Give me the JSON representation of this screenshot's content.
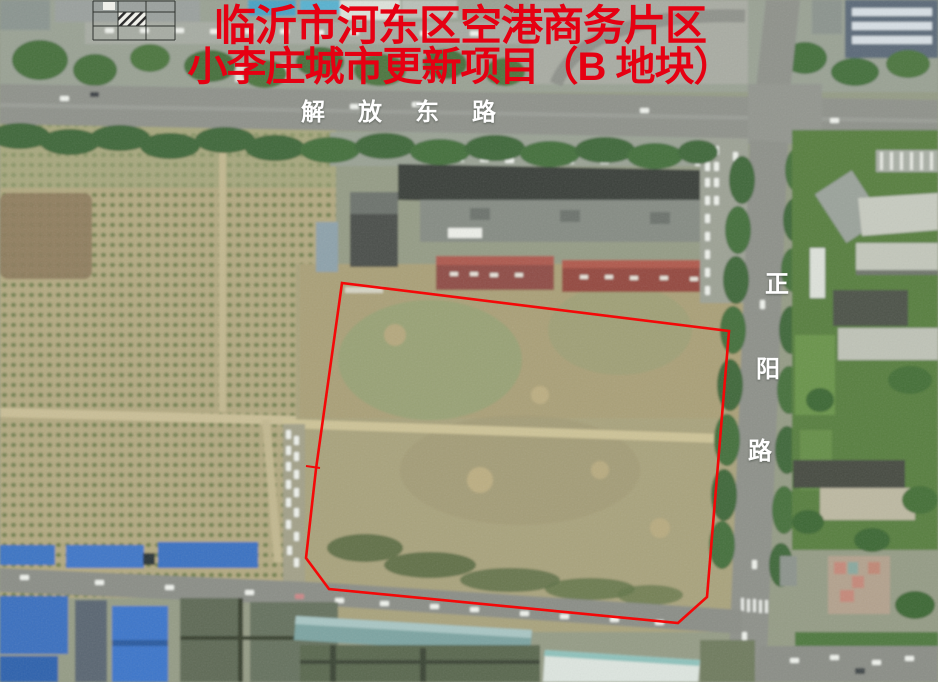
{
  "title": {
    "line1": "临沂市河东区空港商务片区",
    "line2": "小李庄城市更新项目（B 地块）",
    "color": "#e60012"
  },
  "roads": {
    "east_west": {
      "label": "解放东路"
    },
    "north_south": {
      "label": "正阳路",
      "chars": [
        "正",
        "阳",
        "路"
      ]
    }
  },
  "boundary": {
    "color": "#f40808",
    "points": "342,283 729,331 707,597 678,623 329,589 306,558 316,469"
  },
  "colors": {
    "title_red": "#e60012",
    "road_label_white": "#ffffff",
    "boundary_red": "#f40808",
    "blue_warehouse_roof": "#3d74c6",
    "farmland_tan": "#b2a981",
    "plot_khaki": "#a8a27c",
    "road_gray": "#8f928b",
    "tree_green": "#40683a",
    "red_building_roof": "#8f4e46"
  }
}
